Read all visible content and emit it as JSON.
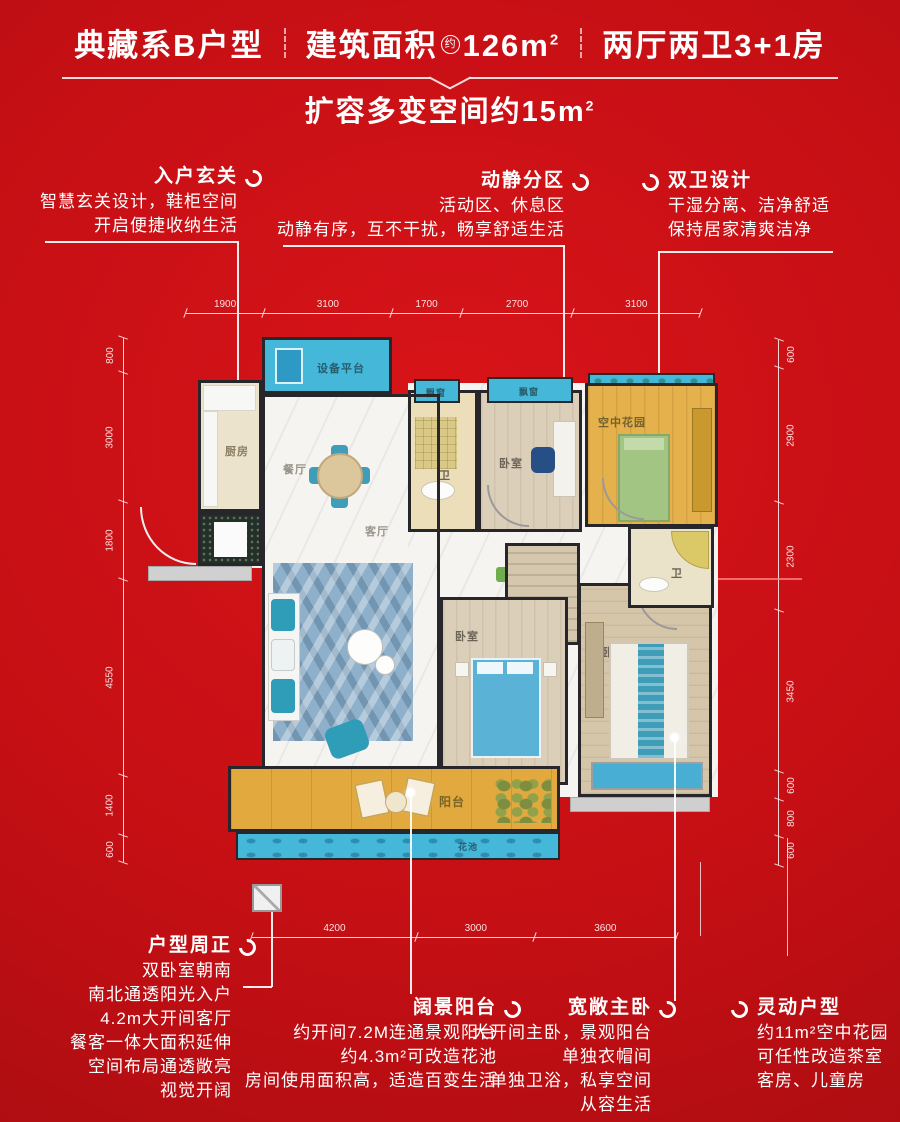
{
  "header": {
    "series_title": "典藏系B户型",
    "area_label": "建筑面积",
    "area_circle": "约",
    "area_value": "126m",
    "area_sup": "2",
    "rooms_label": "两厅两卫3+1房",
    "subtitle": "扩容多变空间约15m",
    "subtitle_sup": "2"
  },
  "callouts_top": [
    {
      "title": "入户玄关",
      "lines": [
        "智慧玄关设计，鞋柜空间",
        "开启便捷收纳生活"
      ]
    },
    {
      "title": "动静分区",
      "lines": [
        "活动区、休息区",
        "动静有序，互不干扰，畅享舒适生活"
      ]
    },
    {
      "title": "双卫设计",
      "lines": [
        "干湿分离、洁净舒适",
        "保持居家清爽洁净"
      ]
    }
  ],
  "callouts_bottom": [
    {
      "title": "户型周正",
      "lines": [
        "双卧室朝南",
        "南北通透阳光入户",
        "4.2m大开间客厅",
        "餐客一体大面积延伸",
        "空间布局通透敞亮",
        "视觉开阔"
      ]
    },
    {
      "title": "阔景阳台",
      "lines": [
        "约开间7.2M连通景观阳台",
        "约4.3m²可改造花池",
        "房间使用面积高，适造百变生活"
      ]
    },
    {
      "title": "宽敞主卧",
      "lines": [
        "大开间主卧，景观阳台",
        "单独衣帽间",
        "单独卫浴，私享空间",
        "从容生活"
      ]
    },
    {
      "title": "灵动户型",
      "lines": [
        "约11m²空中花园",
        "可任性改造茶室",
        "客房、儿童房"
      ]
    }
  ],
  "floorplan": {
    "rooms": {
      "equipment_platform": "设备平台",
      "kitchen": "厨房",
      "dining": "餐厅",
      "living": "客厅",
      "bath_top": "卫",
      "bath_master": "卫",
      "bedroom_top": "卧室",
      "bedroom_mid": "卧室",
      "master_bedroom": "主卧",
      "sky_garden": "空中花园",
      "cloakroom": "衣帽",
      "balcony": "阳台",
      "flower_bed": "花池",
      "bay_window_1": "飘窗",
      "bay_window_2": "飘窗"
    },
    "dims": {
      "top": [
        "1900",
        "3100",
        "1700",
        "2700",
        "3100"
      ],
      "left": [
        "800",
        "3000",
        "1800",
        "4550",
        "1400",
        "600"
      ],
      "right": [
        "600",
        "2900",
        "2300",
        "3450",
        "600",
        "800",
        "600"
      ],
      "bottom": [
        "4200",
        "3000",
        "3600"
      ]
    }
  },
  "colors": {
    "background_red": "#c40f14",
    "accent_cyan": "#45b8da",
    "accent_yellow": "#e2aa41",
    "wall_dark": "#26262b",
    "text_white": "#ffffff"
  }
}
